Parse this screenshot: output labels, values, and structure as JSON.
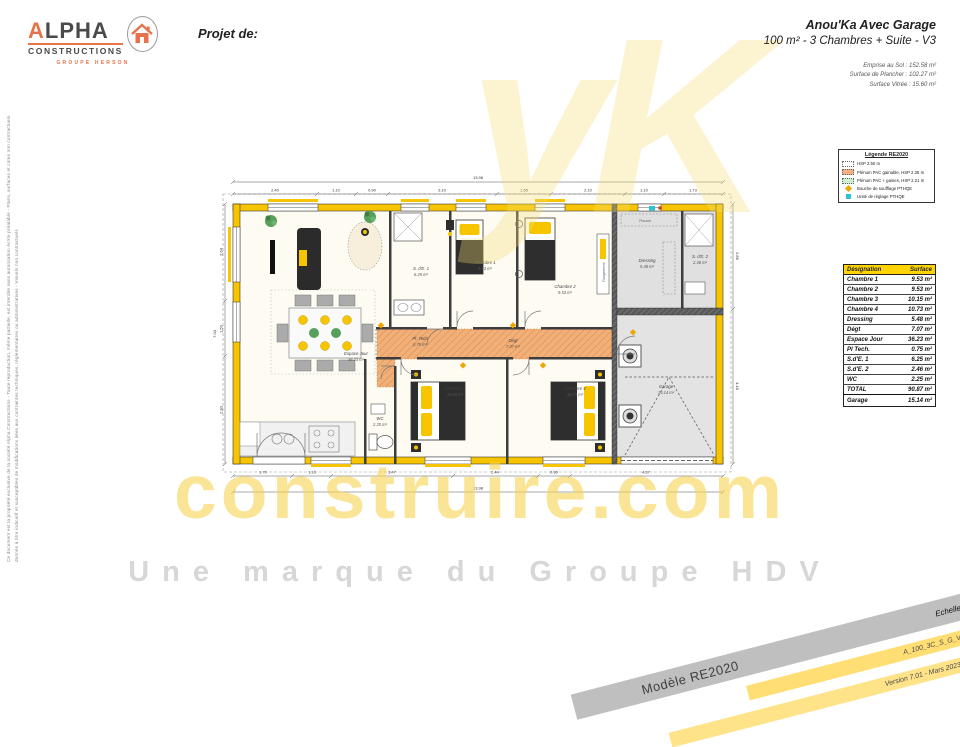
{
  "disclaimer": {
    "line1": "Ce document est la propriété exclusive de la société Alpha Constructions - Toute reproduction, même partielle, est interdite sans autorisation écrite préalable - Plans, surfaces et cotes non contractuels",
    "line2": "donnés à titre indicatif et susceptibles de modifications liées aux contraintes techniques, réglementaires ou administratives - Visuels non contractuels"
  },
  "logo": {
    "name": "ALPHA",
    "word": "CONSTRUCTIONS",
    "group": "GROUPE HERSON",
    "house_icon": "house-stamp"
  },
  "header": {
    "projet_label": "Projet de:",
    "title": "Anou'Ka Avec Garage",
    "subtitle": "100 m² - 3 Chambres + Suite - V3",
    "metrics": [
      "Emprise au Sol : 152.58 m²",
      "Surface de Plancher : 102.27 m²",
      "Surface Vitrée : 15.60 m²"
    ]
  },
  "legend": {
    "title": "Légende RE2020",
    "items": [
      {
        "swatch": "dotted",
        "label": "HSP 2.50 m"
      },
      {
        "swatch": "orange",
        "label": "Plénum PAC gainable, HSP 2.35 m"
      },
      {
        "swatch": "green",
        "label": "Plénum PAC + gaines, HSP 2.21 m"
      },
      {
        "swatch": "orange-dot",
        "label": "Bouche de soufflage PTHQE"
      },
      {
        "swatch": "cyan-dot",
        "label": "Unité de réglage PTHQE"
      }
    ]
  },
  "table": {
    "headers": [
      "Désignation",
      "Surface"
    ],
    "rows": [
      {
        "name": "Chambre 1",
        "value": "9.53 m²"
      },
      {
        "name": "Chambre 2",
        "value": "9.53 m²"
      },
      {
        "name": "Chambre 3",
        "value": "10.15 m²"
      },
      {
        "name": "Chambre 4",
        "value": "10.73 m²"
      },
      {
        "name": "Dressing",
        "value": "5.48 m²"
      },
      {
        "name": "Dégt",
        "value": "7.07 m²"
      },
      {
        "name": "Espace Jour",
        "value": "36.23 m²"
      },
      {
        "name": "Pl Tech.",
        "value": "0.75 m²"
      },
      {
        "name": "S.d'E. 1",
        "value": "6.25 m²"
      },
      {
        "name": "S.d'E. 2",
        "value": "2.46 m²"
      },
      {
        "name": "WC",
        "value": "2.25 m²"
      }
    ],
    "total": {
      "name": "TOTAL",
      "value": "90.87 m²"
    },
    "garage": {
      "name": "Garage",
      "value": "15.14 m²"
    }
  },
  "watermark": {
    "glyphs": "yK",
    "brand": "construire.com",
    "tagline": "Une marque du Groupe HDV"
  },
  "banners": {
    "model": "Modèle RE2020",
    "scale": "Echelle : 1/75e",
    "ref": "A_100_3C_S_G_V3",
    "version": "Version 7.01 - Mars 2023"
  },
  "plan": {
    "rooms": [
      {
        "name": "Espace Jour",
        "area": "36.23 m²"
      },
      {
        "name": "S. d'E. 1",
        "area": "6.25 m²"
      },
      {
        "name": "Chambre 1",
        "area": "9.53 m²"
      },
      {
        "name": "Chambre 2",
        "area": "9.53 m²"
      },
      {
        "name": "Dressing",
        "area": "5.48 m²"
      },
      {
        "name": "S. d'E. 2",
        "area": "2.46 m²"
      },
      {
        "name": "Pl. Tech",
        "area": "0.75 m²"
      },
      {
        "name": "Dégt",
        "area": "7.07 m²"
      },
      {
        "name": "WC",
        "area": "2.25 m²"
      },
      {
        "name": "Chambre 3",
        "area": "10.15 m²"
      },
      {
        "name": "Chambre 4",
        "area": "10.73 m²"
      },
      {
        "name": "Garage",
        "area": "15.14 m²"
      }
    ],
    "labels": {
      "rangements": "Rangements",
      "placard": "Placard"
    },
    "dims": {
      "top_overall": "13.98",
      "top": [
        "2.40",
        "1.10",
        "0.90",
        "3.10",
        "1.55",
        "2.10",
        "1.10",
        "1.73"
      ],
      "bottom": [
        "1.70",
        "1.10",
        "3.47",
        "2.44",
        "0.90",
        "4.37"
      ],
      "bottom_overall": "13.98",
      "left": [
        "2.64",
        "1.50",
        "2.90"
      ],
      "left_overall": "7.04",
      "right": [
        "2.86",
        "4.18"
      ]
    }
  }
}
